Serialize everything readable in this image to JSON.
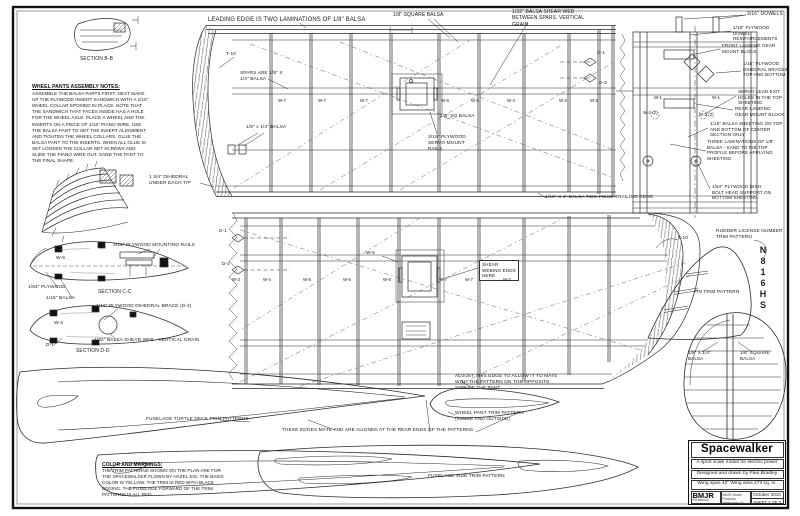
{
  "meta": {
    "sheet_kind": "balsa model aircraft construction plan",
    "ink_color": "#2b2b2b",
    "paper_color": "#ffffff"
  },
  "labels": {
    "leading_edge": "LEADING EDGE IS TWO LAMINATIONS OF 1/8\" BALSA",
    "sq_balsa_top": "1/8\" SQUARE BALSA",
    "shear_web_top": "1/32\" BALSA SHEAR WEB BETWEEN SPARS. VERTICAL GRAIN.",
    "dowels": "3/16\" DOWELS",
    "dowel_reinf": "1/16\" PLYWOOD DOWEL REINFORCEMENTS",
    "front_lg": "FRONT LANDING GEAR MOUNT BLOCK",
    "dihedral_braces": "1/16\" PLYWOOD DIHEDRAL BRACES TOP AND BOTTOM",
    "servo_exit": "SERVO LEAD EXIT HOLES IN THE TOP SHEETING",
    "rear_lg": "REAR LANDING GEAR MOUNT BLOCK",
    "sheeting_116": "1/16\" BALSA SHEETING ON TOP AND BOTTOM OF CENTER SECTION ONLY",
    "three_lam": "THREE LAMINATIONS OF 1/8\" BALSA - SAND TO RIB TOP PROFILE BEFORE APPLYING SHEETING",
    "dish_bolt": "1/64\" PLYWOOD DISH BOLT HEAD SUPPORT ON BOTTOM SHEETING",
    "te_two_piece": "1/16\" X 1\" BALSA TWO PIECE TRAILING EDGE",
    "spars": "SPARS ARE 1/8\" X 1/4\" BALSA",
    "balsa_18x14": "1/8\" x 1/4\" BALSA",
    "t10_top": "T-10",
    "dihedral_tip": "1 3/4\" DIHEDRAL UNDER EACH TIP",
    "sq_balsa_servo": "1/8\" SQ BALSA",
    "servo_rails": "3/16\" PLYWOOD SERVO MOUNT RAILS",
    "d1_top": "D-1",
    "d2_top": "D-2",
    "rudder_license": "RUDDER LICENSE NUMBER TRIM PATTERN",
    "fin_trim": "FIN TRIM PATTERN",
    "t10_bottom": "T-10",
    "rudder_balsa_18x14": "1/8\" X 1/4\" BALSA",
    "rudder_sq_balsa": "1/8\" SQUARE BALSA",
    "shear_ends": "SHEAR WEBING ENDS HERE",
    "w5_callout": "W-5",
    "adjust_edge": "ADJUST THIS EDGE TO ALLOW IT TO MATE WITH THE PATTERN ON THE OPPOSITE SIDE OF THE PANT",
    "pant_trim": "WHEEL PANT TRIM PATTERN (INSIDE AND OUTSIDE)",
    "these_edges": "THESE EDGES MATE AND ARE ALIGNED AT THE REAR ENDS OF THE PATTERNS",
    "turtle_deck": "FUSELAGE TURTLE DECK TRIM PATTERNS",
    "side_trim": "FUSELAGE SIDE TRIM PATTERN",
    "mounting_rails": "3/16\" PLYWOOD MOUNTING RAILS",
    "ply_164": "1/64\" PLYWOOD",
    "balsa_116": "1/16\" BALSA",
    "section_cc": "SECTION C-C",
    "dihedral_d2": "1/16\" PLYWOOD DIHEDRAL BRACE (D-2)",
    "shear_dd": "1/32\" BALSA SHEAR WEB - VERTICAL GRAIN",
    "section_dd": "SECTION D-D",
    "section_bb": "SECTION B-B",
    "d1_bw": "D-1",
    "d2_bw": "D-2",
    "d1_dd": "D-1",
    "w6_cc": "W-6",
    "w4_dd": "W-4"
  },
  "ribs": {
    "top": [
      "W-7",
      "W-7",
      "W-7",
      "W-6",
      "W-5",
      "W-4",
      "W-3",
      "W-2"
    ],
    "bottom": [
      "W-3",
      "W-4",
      "W-5",
      "W-6",
      "W-6",
      "W-7",
      "W-7",
      "W-7"
    ],
    "center": [
      "W-1",
      "W-1",
      "W-2 (2)",
      "W-2 (2)"
    ]
  },
  "n_number": [
    "N",
    "8",
    "1",
    "6",
    "H",
    "S"
  ],
  "notes": {
    "wheel": {
      "title": "WHEEL PANTS ASSEMBLY NOTES:",
      "body": "ASSEMBLE THE BALSA PARTS FIRST. NEXT MAKE UP THE PLYWOOD INSERT SANDWICH WITH A 1/16\" WHEEL COLLAR EPOXIED IN PLACE. NOTE THAT THE SANDWICH THAT FACES INSIDE HAS A HOLE FOR THE WHEEL AXLE. PLACE A WHEEL AND THE INSERTS ON A PIECE OF 1/16\" PIANO WIRE. USE THE BALSA PANT TO SET THE INSERT ALIGNMENT AND TIGHTEN THE WHEEL COLLARS. GLUE THE BALSA PANT TO THE INSERTS. WHEN ALL GLUE IS SET LOOSEN THE COLLAR SET SCREWS AND SLIDE THE PIANO WIRE OUT. SAND THE PANT TO THE FINAL SHAPE."
    },
    "color": {
      "title": "COLOR AND MARKINGS:",
      "body": "THE TRIM PATTERNS SHOWN ON THE PLAN ARE FOR THE SPACEWALKER FLOWN BY HAZEL SIG. THE BASIC COLOR IS YELLOW. THE TRIM IS RED WITH BLACK EDGING. THE FUSELAGE FORWARD OF THE TRIM PATTERNS IS ALL RED."
    }
  },
  "title_block": {
    "title": "Spacewalker",
    "subtitle": "A sport scale model for electric power",
    "credit": "Designed and drawn by Paul Bradley",
    "specs": "Wing span 42\"  Wing area 273 sq. in.",
    "brand": "BMJR",
    "kit": "Kit #xxxxx",
    "address1": "BMJR Model Products",
    "address2": "Melbourne, FL 32936",
    "date": "October 2010",
    "sheet": "SHEET 2 OF 2"
  }
}
